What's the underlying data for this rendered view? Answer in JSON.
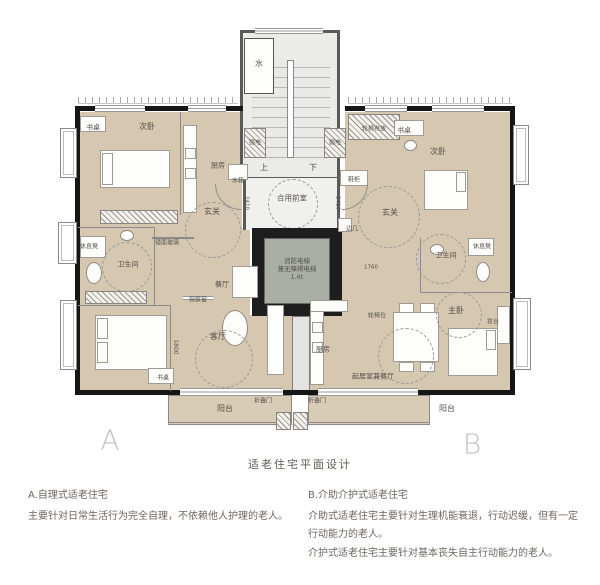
{
  "caption": "适老住宅平面设计",
  "unit_markers": {
    "a": "A",
    "b": "B"
  },
  "legend": {
    "a_heading": "A.自理式适老住宅",
    "a_body": "主要针对日常生活行为完全自理，不依赖他人护理的老人。",
    "b_heading": "B.介助介护式适老住宅",
    "b_body1": "介助式适老住宅主要针对生理机能衰退，行动迟缓，但有一定行动能力的老人。",
    "b_body2": "介护式适老住宅主要针对基本丧失自主行动能力的老人。"
  },
  "colors": {
    "room_fill": "#d5c7b0",
    "balcony_fill": "#d9ccb6",
    "core_fill": "#ebebe9",
    "vestibule_fill": "#f0f0ee",
    "elevator_interior": "#a9afa5",
    "elevator_wall": "#1e1e1e",
    "exterior_wall": "#161616",
    "label_text": "#55504a",
    "marker_letter": "#c2c2c2",
    "legend_text": "#6e665e"
  },
  "plan": {
    "labels": [
      {
        "name": "water-meter-label",
        "t": "水",
        "x": 259,
        "y": 64,
        "s": 8
      },
      {
        "name": "stairs-up-label",
        "t": "上",
        "x": 264,
        "y": 168,
        "s": 8
      },
      {
        "name": "stairs-down-label",
        "t": "下",
        "x": 313,
        "y": 168,
        "s": 8
      },
      {
        "name": "shared-vestibule-label",
        "t": "合用前室",
        "x": 292,
        "y": 198,
        "s": 7.5
      },
      {
        "name": "fire-elevator-label",
        "t": "消防电梯\n兼无障碍电梯\n1.6t",
        "x": 297,
        "y": 269,
        "s": 6.5
      },
      {
        "name": "strong-electric-label",
        "t": "强电",
        "x": 255,
        "y": 143,
        "s": 6
      },
      {
        "name": "weak-electric-label",
        "t": "弱电",
        "x": 335,
        "y": 143,
        "s": 6
      },
      {
        "name": "water-tank-label",
        "t": "水箱",
        "x": 238,
        "y": 181,
        "s": 6
      },
      {
        "name": "shoe-cabinet-label",
        "t": "鞋柜",
        "x": 354,
        "y": 180,
        "s": 6
      },
      {
        "name": "side-table-label",
        "t": "边几",
        "x": 352,
        "y": 229,
        "s": 6
      },
      {
        "name": "wheelchair-storage-label",
        "t": "轮椅存放",
        "x": 374,
        "y": 129,
        "s": 6
      },
      {
        "name": "a-desk-label",
        "t": "书桌",
        "x": 93,
        "y": 128,
        "s": 7
      },
      {
        "name": "a-bedroom2-label",
        "t": "次卧",
        "x": 147,
        "y": 127,
        "s": 8
      },
      {
        "name": "a-kitchen-label",
        "t": "厨房",
        "x": 218,
        "y": 166,
        "s": 7
      },
      {
        "name": "a-entry-label",
        "t": "玄关",
        "x": 212,
        "y": 212,
        "s": 8
      },
      {
        "name": "a-mirror-glass-label",
        "t": "镜面玻璃",
        "x": 167,
        "y": 243,
        "s": 6
      },
      {
        "name": "a-rest-bench-label",
        "t": "休息凳",
        "x": 89,
        "y": 247,
        "s": 6
      },
      {
        "name": "a-bathroom-label",
        "t": "卫生间",
        "x": 128,
        "y": 265,
        "s": 7
      },
      {
        "name": "a-dining-label",
        "t": "餐厅",
        "x": 222,
        "y": 285,
        "s": 7
      },
      {
        "name": "a-observation-window-label",
        "t": "观察窗",
        "x": 198,
        "y": 300,
        "s": 6
      },
      {
        "name": "a-living-label",
        "t": "客厅",
        "x": 218,
        "y": 337,
        "s": 8
      },
      {
        "name": "a-desk2-label",
        "t": "书桌",
        "x": 163,
        "y": 378,
        "s": 6
      },
      {
        "name": "a-balcony-label",
        "t": "阳台",
        "x": 225,
        "y": 409,
        "s": 8
      },
      {
        "name": "a-folding-door-label",
        "t": "折叠门",
        "x": 263,
        "y": 401,
        "s": 6
      },
      {
        "name": "b-desk-label",
        "t": "书桌",
        "x": 404,
        "y": 131,
        "s": 7
      },
      {
        "name": "b-bedroom2-label",
        "t": "次卧",
        "x": 438,
        "y": 152,
        "s": 8
      },
      {
        "name": "b-entry-label",
        "t": "玄关",
        "x": 390,
        "y": 213,
        "s": 8
      },
      {
        "name": "b-rest-bench-label",
        "t": "休息凳",
        "x": 482,
        "y": 247,
        "s": 6
      },
      {
        "name": "b-bathroom-label",
        "t": "卫生间",
        "x": 446,
        "y": 256,
        "s": 7
      },
      {
        "name": "b-master-bedroom-label",
        "t": "主卧",
        "x": 456,
        "y": 311,
        "s": 8
      },
      {
        "name": "b-dressing-table-label",
        "t": "妆台",
        "x": 493,
        "y": 322,
        "s": 6
      },
      {
        "name": "b-kitchen-label",
        "t": "厨房",
        "x": 323,
        "y": 350,
        "s": 7
      },
      {
        "name": "b-wheelchair-spot-label",
        "t": "轮椅位",
        "x": 377,
        "y": 316,
        "s": 6
      },
      {
        "name": "b-living-dining-label",
        "t": "起居室兼餐厅",
        "x": 373,
        "y": 377,
        "s": 7
      },
      {
        "name": "b-balcony-label",
        "t": "阳台",
        "x": 447,
        "y": 409,
        "s": 8
      },
      {
        "name": "b-folding-door-label",
        "t": "折叠门",
        "x": 317,
        "y": 401,
        "s": 6
      },
      {
        "name": "dim-1800",
        "t": "1800",
        "x": 175,
        "y": 347,
        "s": 6,
        "v": true
      },
      {
        "name": "dim-2410-left",
        "t": "2410",
        "x": 246,
        "y": 203,
        "s": 5.5,
        "v": true
      },
      {
        "name": "dim-2410-right",
        "t": "2410",
        "x": 337,
        "y": 203,
        "s": 5.5,
        "v": true
      },
      {
        "name": "dim-1760",
        "t": "1760",
        "x": 371,
        "y": 268,
        "s": 5.5
      }
    ]
  }
}
